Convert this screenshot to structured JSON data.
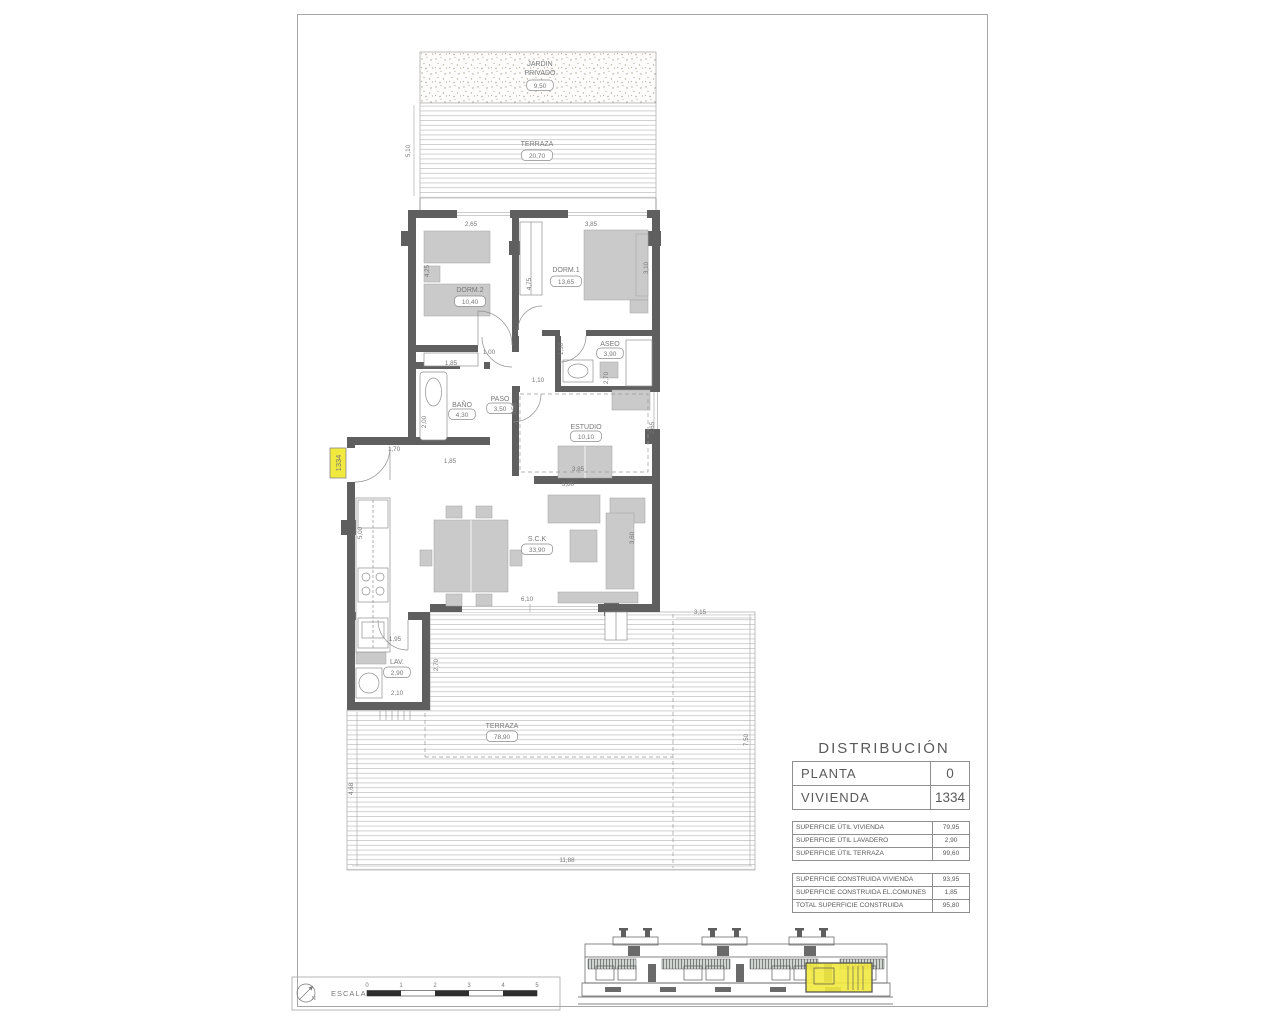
{
  "colors": {
    "wall": "#5f5f5f",
    "furniture": "#cacaca",
    "highlight_yellow": "#f2e93f",
    "line": "#8f8f8f",
    "label_text": "#787878"
  },
  "unit_tag": "1334",
  "distribution": {
    "title": "DISTRIBUCIÓN",
    "main_rows": [
      [
        "PLANTA",
        "0"
      ],
      [
        "VIVIENDA",
        "1334"
      ]
    ],
    "area_tables": [
      {
        "rows": [
          [
            "SUPERFICIE ÚTIL VIVIENDA",
            "79,95"
          ],
          [
            "SUPERFICIE ÚTIL LAVADERO",
            "2,90"
          ],
          [
            "SUPERFICIE ÚTIL TERRAZA",
            "99,60"
          ]
        ]
      },
      {
        "rows": [
          [
            "SUPERFICIE CONSTRUIDA VIVIENDA",
            "93,95"
          ],
          [
            "SUPERFICIE CONSTRUIDA EL.COMUNES",
            "1,85"
          ],
          [
            "TOTAL SUPERFICIE CONSTRUIDA",
            "95,80"
          ]
        ]
      }
    ]
  },
  "rooms": [
    {
      "lines": [
        "JARDIN",
        "PRIVADO"
      ],
      "value": "9,50",
      "x": 540,
      "ys": [
        66,
        75
      ],
      "by": 88
    },
    {
      "lines": [
        "TERRAZA"
      ],
      "value": "20,70",
      "x": 537,
      "ys": [
        146
      ],
      "by": 158
    },
    {
      "lines": [
        "DORM.2"
      ],
      "value": "10,40",
      "x": 470,
      "ys": [
        292
      ],
      "by": 304
    },
    {
      "lines": [
        "DORM.1"
      ],
      "value": "13,65",
      "x": 566,
      "ys": [
        272
      ],
      "by": 284
    },
    {
      "lines": [
        "ASEO"
      ],
      "value": "3,90",
      "x": 610,
      "ys": [
        346
      ],
      "by": 356
    },
    {
      "lines": [
        "BAÑO"
      ],
      "value": "4,30",
      "x": 462,
      "ys": [
        407
      ],
      "by": 417
    },
    {
      "lines": [
        "PASO"
      ],
      "value": "3,50",
      "x": 500,
      "ys": [
        401
      ],
      "by": 411
    },
    {
      "lines": [
        "ESTUDIO"
      ],
      "value": "10,10",
      "x": 586,
      "ys": [
        429
      ],
      "by": 439
    },
    {
      "lines": [
        "S.C.K"
      ],
      "value": "33,90",
      "x": 537,
      "ys": [
        541
      ],
      "by": 552
    },
    {
      "lines": [
        "LAV."
      ],
      "value": "2,90",
      "x": 397,
      "ys": [
        664
      ],
      "by": 675
    },
    {
      "lines": [
        "TERRAZA"
      ],
      "value": "78,90",
      "x": 502,
      "ys": [
        728
      ],
      "by": 739
    }
  ],
  "dimensions": [
    {
      "t": "5,10",
      "x": 410,
      "y": 151,
      "r": 1
    },
    {
      "t": "2,65",
      "x": 471,
      "y": 226,
      "r": 0
    },
    {
      "t": "3,85",
      "x": 591,
      "y": 226,
      "r": 0
    },
    {
      "t": "4,25",
      "x": 429,
      "y": 271,
      "r": 1
    },
    {
      "t": "4,75",
      "x": 531,
      "y": 284,
      "r": 1
    },
    {
      "t": "3,10",
      "x": 648,
      "y": 268,
      "r": 1
    },
    {
      "t": "1,85",
      "x": 451,
      "y": 365,
      "r": 0
    },
    {
      "t": "1,00",
      "x": 489,
      "y": 354,
      "r": 0
    },
    {
      "t": "1,50",
      "x": 563,
      "y": 349,
      "r": 1
    },
    {
      "t": "2,70",
      "x": 608,
      "y": 378,
      "r": 1
    },
    {
      "t": "1,10",
      "x": 538,
      "y": 382,
      "r": 0
    },
    {
      "t": "3,50",
      "x": 516,
      "y": 409,
      "r": 1
    },
    {
      "t": "2,00",
      "x": 426,
      "y": 422,
      "r": 1
    },
    {
      "t": "2,65",
      "x": 654,
      "y": 428,
      "r": 1
    },
    {
      "t": "3,85",
      "x": 578,
      "y": 471,
      "r": 0
    },
    {
      "t": "3,80",
      "x": 568,
      "y": 486,
      "r": 0
    },
    {
      "t": "1,70",
      "x": 394,
      "y": 451,
      "r": 0
    },
    {
      "t": "1,85",
      "x": 450,
      "y": 463,
      "r": 0
    },
    {
      "t": "5,00",
      "x": 362,
      "y": 533,
      "r": 1
    },
    {
      "t": "3,60",
      "x": 634,
      "y": 538,
      "r": 1
    },
    {
      "t": "6,10",
      "x": 527,
      "y": 601,
      "r": 0
    },
    {
      "t": "1,95",
      "x": 395,
      "y": 641,
      "r": 0
    },
    {
      "t": "2,70",
      "x": 438,
      "y": 665,
      "r": 1
    },
    {
      "t": "2,10",
      "x": 397,
      "y": 695,
      "r": 0
    },
    {
      "t": "3,15",
      "x": 700,
      "y": 614,
      "r": 0
    },
    {
      "t": "7,50",
      "x": 748,
      "y": 740,
      "r": 1
    },
    {
      "t": "4,68",
      "x": 353,
      "y": 789,
      "r": 1
    },
    {
      "t": "11,88",
      "x": 567,
      "y": 862,
      "r": 0
    }
  ],
  "scale_bar": {
    "label": "ESCALA :",
    "numbers": [
      "0",
      "1",
      "2",
      "3",
      "4",
      "5"
    ],
    "north": "N"
  }
}
